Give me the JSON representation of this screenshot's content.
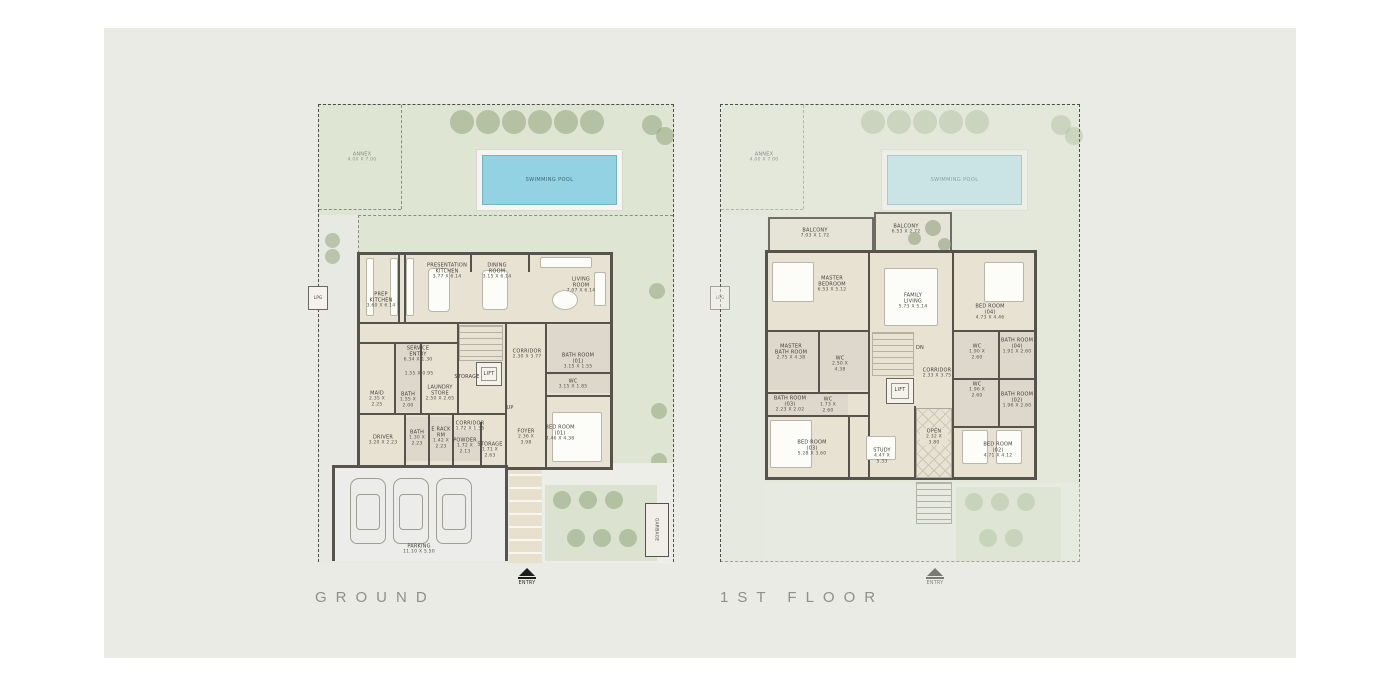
{
  "titles": {
    "ground": "GROUND",
    "first": "1ST FLOOR"
  },
  "entry_label": "ENTRY",
  "site": {
    "annex_name": "ANNEX",
    "annex_dims": "4.00 X 7.00",
    "pool_label": "SWIMMING POOL",
    "lpg_label": "LPG",
    "garbage_label": "GARBAGE"
  },
  "ground": {
    "rooms": [
      {
        "name": "PREP KITCHEN",
        "dims": "3.60 X 6.14"
      },
      {
        "name": "PRESENTATION KITCHEN",
        "dims": "3.77 X 6.14"
      },
      {
        "name": "DINING ROOM",
        "dims": "3.15 X 6.14"
      },
      {
        "name": "LIVING ROOM",
        "dims": "7.07 X 6.14"
      },
      {
        "name": "SERVICE ENTRY",
        "dims": "6.34 X 1.30"
      },
      {
        "name": "",
        "dims": "1.55 X 0.95"
      },
      {
        "name": "CORRIDOR",
        "dims": "2.30 X 3.77"
      },
      {
        "name": "BATH ROOM (01)",
        "dims": "3.15 X 1.55"
      },
      {
        "name": "WC",
        "dims": "3.15 X 1.85"
      },
      {
        "name": "MAID",
        "dims": "2.35 X 2.25"
      },
      {
        "name": "BATH",
        "dims": "1.55 X 2.00"
      },
      {
        "name": "LAUNDRY STORE",
        "dims": "2.50 X 2.65"
      },
      {
        "name": "STORAGE",
        "dims": ""
      },
      {
        "name": "LIFT",
        "dims": ""
      },
      {
        "name": "UP",
        "dims": ""
      },
      {
        "name": "DRIVER",
        "dims": "3.20 X 2.23"
      },
      {
        "name": "BATH",
        "dims": "1.30 X 2.23"
      },
      {
        "name": "E RACK RM",
        "dims": "1.42 X 2.23"
      },
      {
        "name": "CORRIDOR",
        "dims": "1.72 X 1.35"
      },
      {
        "name": "POWDER",
        "dims": "1.72 X 2.13"
      },
      {
        "name": "STORAGE",
        "dims": "1.71 X 2.63"
      },
      {
        "name": "FOYER",
        "dims": "2.36 X 3.98"
      },
      {
        "name": "BED ROOM (01)",
        "dims": "4.46 X 4.38"
      },
      {
        "name": "PARKING",
        "dims": "11.10 X 5.50"
      }
    ]
  },
  "first": {
    "rooms": [
      {
        "name": "BALCONY",
        "dims": "7.03 X 1.72"
      },
      {
        "name": "BALCONY",
        "dims": "6.53 X 2.72"
      },
      {
        "name": "MASTER BEDROOM",
        "dims": "6.53 X 5.12"
      },
      {
        "name": "FAMILY LIVING",
        "dims": "5.73 X 5.14"
      },
      {
        "name": "BED ROOM (04)",
        "dims": "4.73 X 4.46"
      },
      {
        "name": "MASTER BATH ROOM",
        "dims": "2.75 X 4.38"
      },
      {
        "name": "WC",
        "dims": "2.50 X 4.38"
      },
      {
        "name": "WC",
        "dims": "1.90 X 2.60"
      },
      {
        "name": "BATH ROOM (04)",
        "dims": "1.91 X 2.60"
      },
      {
        "name": "WC",
        "dims": "1.96 X 2.60"
      },
      {
        "name": "BATH ROOM (02)",
        "dims": "1.96 X 2.60"
      },
      {
        "name": "BATH ROOM (03)",
        "dims": "2.23 X 2.02"
      },
      {
        "name": "WC",
        "dims": "1.73 X 2.60"
      },
      {
        "name": "DN",
        "dims": ""
      },
      {
        "name": "CORRIDOR",
        "dims": "2.33 X 3.75"
      },
      {
        "name": "LIFT",
        "dims": ""
      },
      {
        "name": "OPEN",
        "dims": "2.32 X 3.80"
      },
      {
        "name": "BED ROOM (03)",
        "dims": "5.28 X 3.60"
      },
      {
        "name": "STUDY",
        "dims": "4.47 X 5.33"
      },
      {
        "name": "BED ROOM (02)",
        "dims": "4.71 X 4.12"
      }
    ]
  }
}
